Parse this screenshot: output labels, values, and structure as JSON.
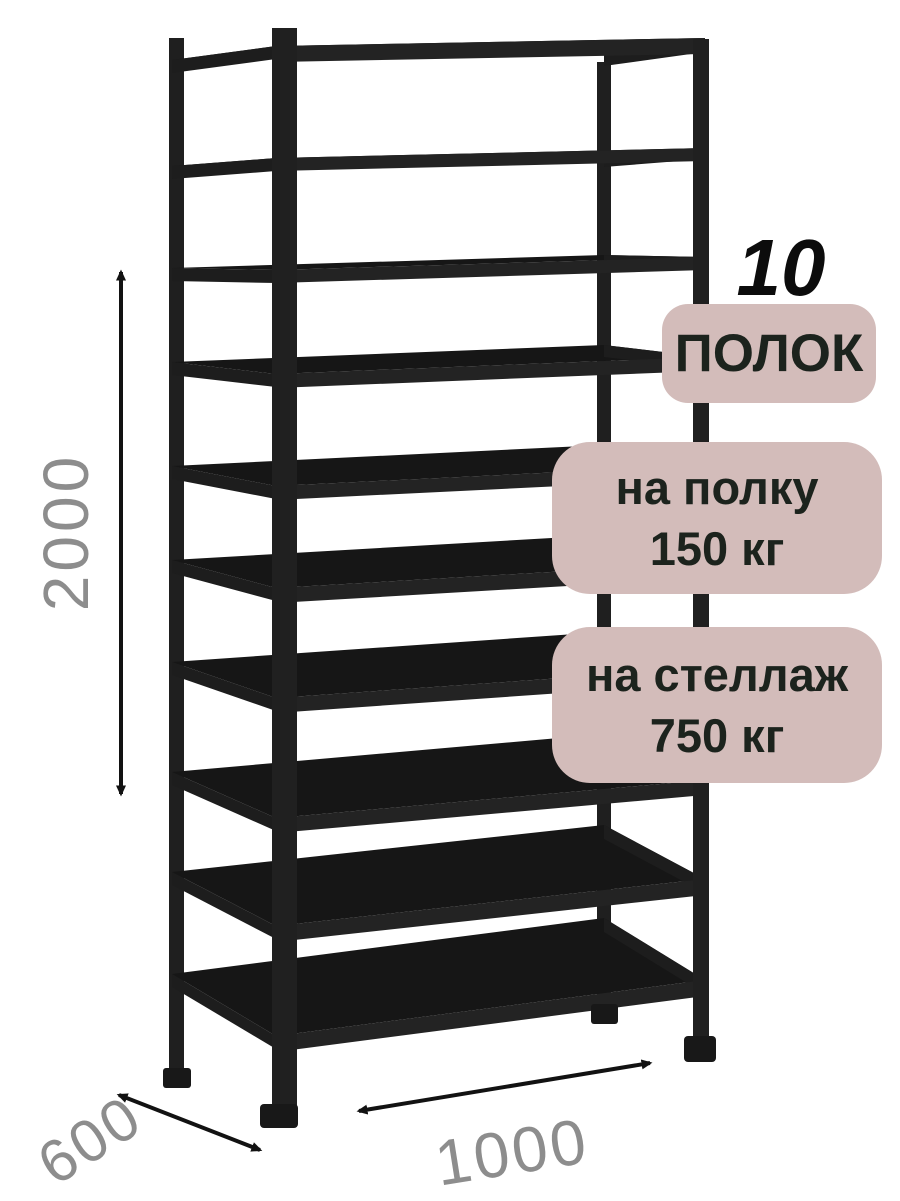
{
  "badges": {
    "count_number": "10",
    "count_label": "ПОЛОК",
    "per_shelf": {
      "line1": "на полку",
      "line2": "150 кг"
    },
    "per_rack": {
      "line1": "на стеллаж",
      "line2": "750 кг"
    }
  },
  "dimensions": {
    "height_mm": "2000",
    "depth_mm": "600",
    "width_mm": "1000"
  },
  "colors": {
    "badge_bg": "#d3bcba",
    "badge_text": "#1c231d",
    "rack_dark": "#161616",
    "rack_mid": "#232323",
    "rack_beam": "#1d1d1d",
    "dimension_label": "#8d8d8d",
    "arrow": "#121212",
    "background": "#ffffff"
  }
}
